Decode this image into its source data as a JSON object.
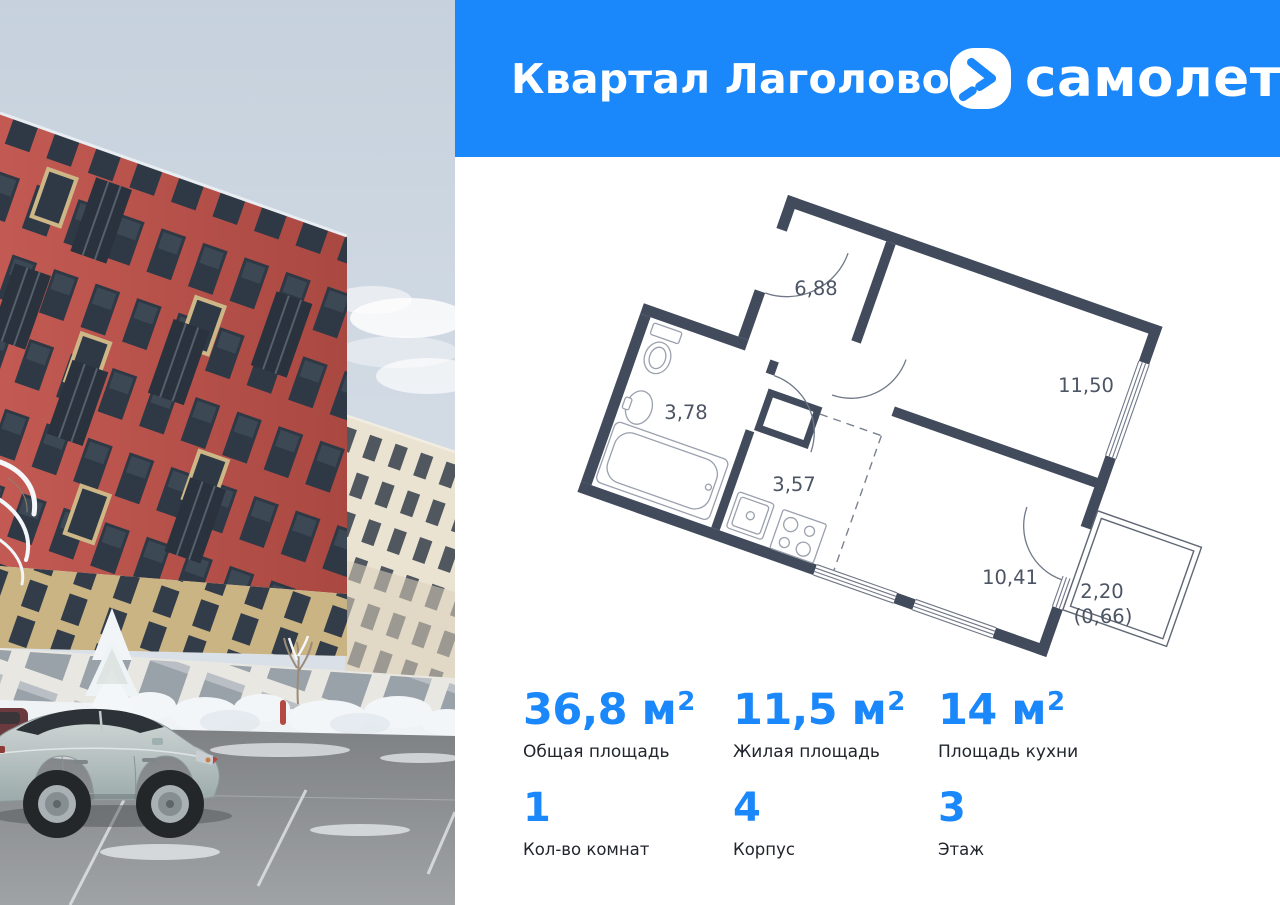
{
  "header": {
    "title": "Квартал Лаголово",
    "brand_name": "самолет",
    "accent_color": "#1a87fb"
  },
  "plan": {
    "wall_color": "#414b5c",
    "rooms": [
      {
        "name": "hallway",
        "area": "6,88"
      },
      {
        "name": "bedroom",
        "area": "11,50"
      },
      {
        "name": "bathroom",
        "area": "3,78"
      },
      {
        "name": "kitchen-corridor",
        "area": "3,57"
      },
      {
        "name": "living-kitchen",
        "area": "10,41"
      },
      {
        "name": "balcony",
        "area": "2,20"
      },
      {
        "name": "balcony-reduced",
        "area": "(0,66)"
      }
    ]
  },
  "stats": {
    "areas": [
      {
        "value": "36,8",
        "unit": "м",
        "sup": "2",
        "label": "Общая площадь"
      },
      {
        "value": "11,5",
        "unit": "м",
        "sup": "2",
        "label": "Жилая площадь"
      },
      {
        "value": "14",
        "unit": "м",
        "sup": "2",
        "label": "Площадь кухни"
      }
    ],
    "attributes": [
      {
        "value": "1",
        "label": "Кол-во комнат"
      },
      {
        "value": "4",
        "label": "Корпус"
      },
      {
        "value": "3",
        "label": "Этаж"
      }
    ]
  }
}
